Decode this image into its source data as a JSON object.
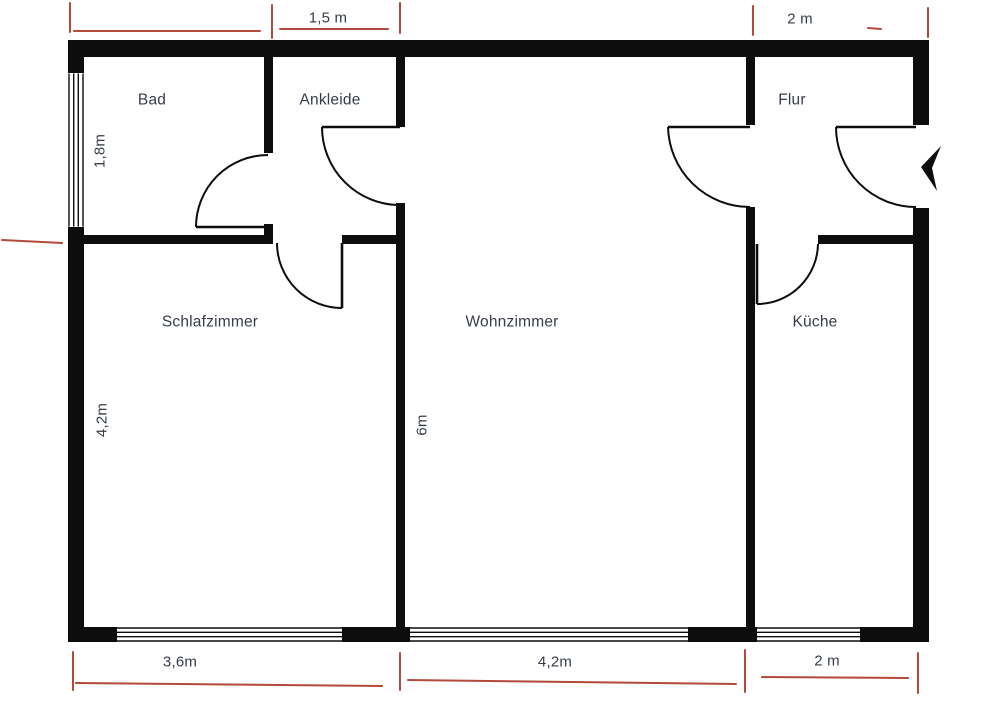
{
  "plan": {
    "title": "Apartment floor plan",
    "rooms": {
      "bad": "Bad",
      "ankleide": "Ankleide",
      "flur": "Flur",
      "schlafzimmer": "Schlafzimmer",
      "wohnzimmer": "Wohnzimmer",
      "kueche": "Küche"
    },
    "dimensions": {
      "top_ankleide_width": "1,5 m",
      "top_flur_width": "2 m",
      "bottom_schlafzimmer_width": "3,6m",
      "bottom_wohnzimmer_width": "4,2m",
      "bottom_kueche_width": "2 m",
      "left_bad_height": "1,8m",
      "left_schlafzimmer_height": "4,2m",
      "middle_wohnzimmer_height": "6m"
    },
    "icons": {
      "entrance_arrow": "left-filled-arrow"
    },
    "colors": {
      "wall": "#0d0d0d",
      "dimension_red": "#b5493c",
      "label_text": "#373d4a",
      "background": "#ffffff"
    }
  }
}
